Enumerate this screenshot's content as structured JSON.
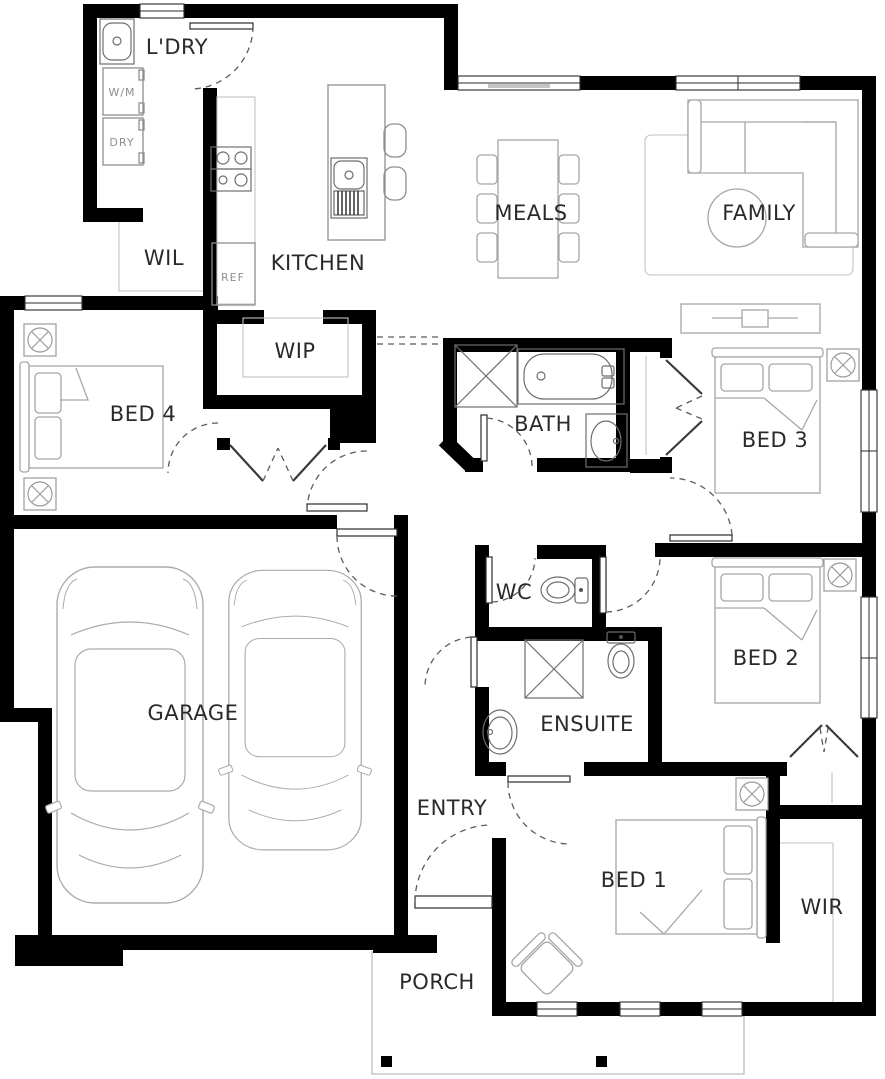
{
  "plan": {
    "type": "residential-floor-plan",
    "colors": {
      "wall": "#000000",
      "fixture_stroke": "#8f8f8f",
      "furniture_stroke": "#a6a6a6",
      "label": "#2a2a2a",
      "door_arc": "#5c5c5c",
      "appliance_label": "#8f8f8f",
      "background": "#ffffff"
    },
    "rooms": {
      "laundry": "L'DRY",
      "wil": "WIL",
      "kitchen": "KITCHEN",
      "wip": "WIP",
      "meals": "MEALS",
      "family": "FAMILY",
      "bed4": "BED 4",
      "bath": "BATH",
      "bed3": "BED 3",
      "wc": "WC",
      "bed2": "BED 2",
      "ensuite": "ENSUITE",
      "garage": "GARAGE",
      "entry": "ENTRY",
      "bed1": "BED 1",
      "wir": "WIR",
      "porch": "PORCH"
    },
    "appliances": {
      "washing_machine": "W/M",
      "dryer": "DRY",
      "fridge": "REF"
    }
  }
}
